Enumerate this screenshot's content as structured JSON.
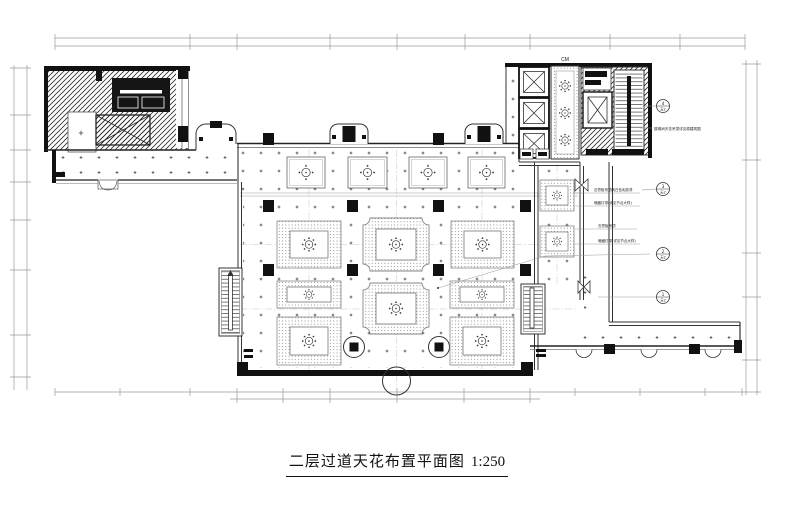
{
  "title": {
    "text": "二层过道天花布置平面图",
    "scale": "1:250"
  },
  "labels": {
    "core_mark": "CM"
  },
  "notes": {
    "stair_block": "楼梯间天花吊顶详见原建筑图",
    "n1": "石膏板吊顶刷白色乳胶漆",
    "n2": "暗藏灯带(详见节点大样)",
    "n3": "石膏板吊顶",
    "n4": "暗藏灯带(详见节点大样)"
  },
  "bubbles": [
    {
      "no": "4",
      "sheet": "天2"
    },
    {
      "no": "3",
      "sheet": "天2"
    },
    {
      "no": "2",
      "sheet": "天2"
    },
    {
      "no": "1",
      "sheet": "天2"
    }
  ],
  "colors": {
    "ink": "#222222",
    "heavy": "#111111",
    "light": "#888888",
    "dim": "#9a9a9a",
    "paper": "#ffffff"
  }
}
